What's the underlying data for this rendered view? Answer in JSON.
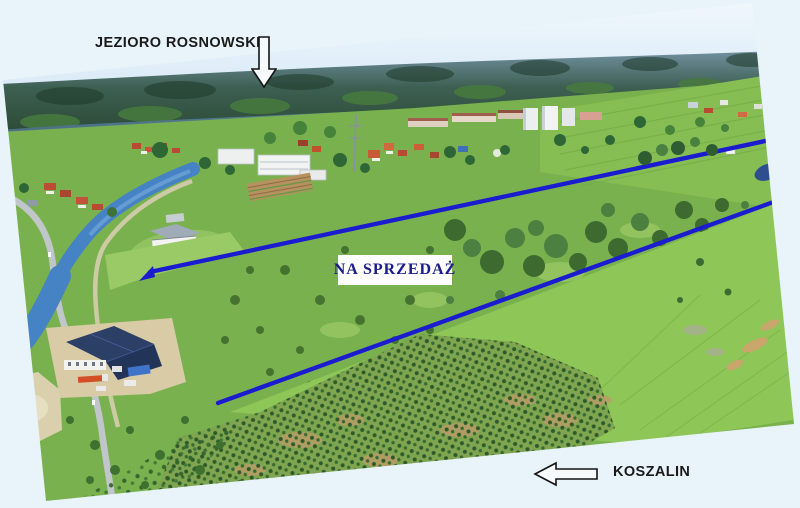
{
  "labels": {
    "lake": "JEZIORO ROSNOWSKIE",
    "for_sale": "NA SPRZEDAŻ",
    "city": "KOSZALIN"
  },
  "icons": {
    "lake_direction": "arrow-down-outline",
    "city_direction": "arrow-left-outline"
  },
  "colors": {
    "page_bg": "#e9f3fa",
    "annotation_text": "#1a1a1a",
    "for_sale_text": "#1b1b8e",
    "for_sale_bg": "#fefefe",
    "boundary_line": "#1b1bd0",
    "arrow_fill": "#f6fafc",
    "arrow_stroke": "#141414"
  }
}
